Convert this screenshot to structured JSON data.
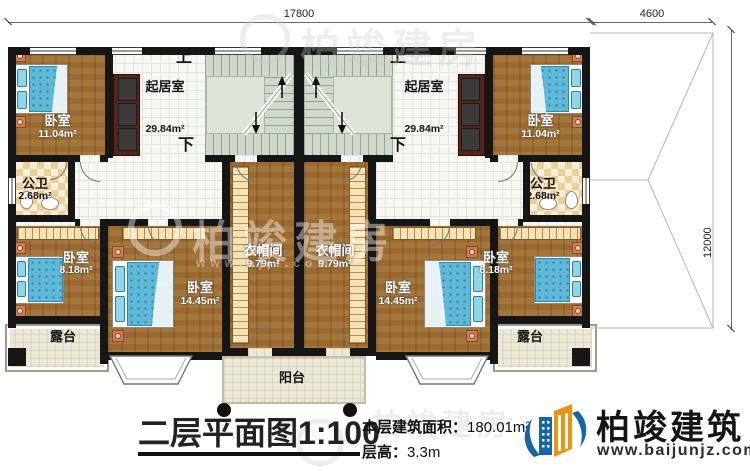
{
  "dims": {
    "width": "17800",
    "annex_width": "4600",
    "depth": "12000"
  },
  "stairs": {
    "up": "上",
    "down": "下"
  },
  "rooms": {
    "living_l": {
      "name": "起居室",
      "area": "29.84m²"
    },
    "living_r": {
      "name": "起居室",
      "area": "29.84m²"
    },
    "bedroom11_l": {
      "name": "卧室",
      "area": "11.04m²"
    },
    "bedroom11_r": {
      "name": "卧室",
      "area": "11.04m²"
    },
    "bath_l": {
      "name": "公卫",
      "area": "2.68m²"
    },
    "bath_r": {
      "name": "公卫",
      "area": "2.68m²"
    },
    "cloak_l": {
      "name": "衣帽间",
      "area": "9.79m²"
    },
    "cloak_r": {
      "name": "衣帽间",
      "area": "9.79m²"
    },
    "bedroom14_l": {
      "name": "卧室",
      "area": "14.45m²"
    },
    "bedroom14_r": {
      "name": "卧室",
      "area": "14.45m²"
    },
    "bedroom8_l": {
      "name": "卧室",
      "area": "8.18m²"
    },
    "bedroom8_r": {
      "name": "卧室",
      "area": "8.18m²"
    },
    "terrace_l": {
      "name": "露台"
    },
    "terrace_r": {
      "name": "露台"
    },
    "balcony": {
      "name": "阳台"
    }
  },
  "titleblock": {
    "title": "二层平面图",
    "scale": "1:100",
    "area_label": "本层建筑面积：",
    "area_value": "180.01m²",
    "height_label": "层高：",
    "height_value": "3.3m"
  },
  "logo": {
    "name": "柏竣建筑",
    "url": "www.baijunjz.com"
  },
  "watermark": {
    "text": "柏竣建房",
    "url": "www.bjjf.com"
  },
  "colors": {
    "wall": "#161616",
    "wood": "#9a6a31",
    "stair": "#cfd8cb",
    "logo_blue": "#1565a8",
    "logo_orange": "#f29111"
  }
}
